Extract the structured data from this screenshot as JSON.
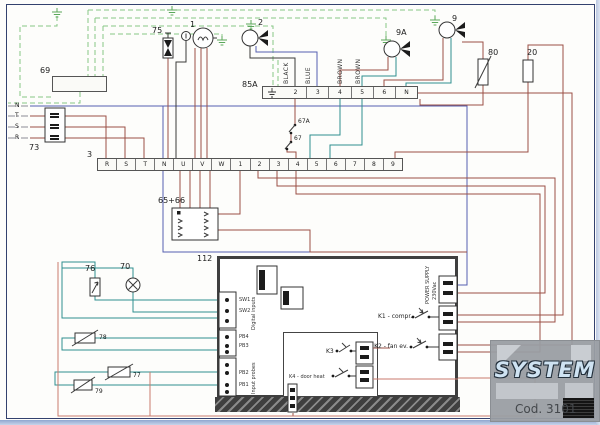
{
  "components": {
    "strip69": {
      "label": "69"
    },
    "fuse75": {
      "label": "75"
    },
    "compressor1": {
      "label": "1"
    },
    "fan2": {
      "label": "2"
    },
    "fan9a": {
      "label": "9A"
    },
    "fan9": {
      "label": "9"
    },
    "heater80": {
      "label": "80"
    },
    "resistor20": {
      "label": "20"
    },
    "fusebox73": {
      "label": "73"
    },
    "connector65_66": {
      "label": "65+66"
    },
    "switch67a": {
      "label": "67A"
    },
    "switch67": {
      "label": "67"
    },
    "door_switch76": {
      "label": "76"
    },
    "lamp70": {
      "label": "70"
    },
    "probe78": {
      "label": "78"
    },
    "probe77": {
      "label": "77"
    },
    "probe79": {
      "label": "79"
    }
  },
  "supply_lines": [
    "N",
    "T",
    "S",
    "R"
  ],
  "wire_labels": [
    "BLACK",
    "BLUE",
    "BROWN",
    "BROWN"
  ],
  "strip3": {
    "label": "3",
    "terminals": [
      "R",
      "S",
      "T",
      "N",
      "U",
      "V",
      "W",
      "1",
      "2",
      "3",
      "4",
      "5",
      "6",
      "7",
      "8",
      "9"
    ]
  },
  "strip85a": {
    "label": "85A",
    "terminals": [
      "2",
      "3",
      "4",
      "5",
      "6",
      "N"
    ]
  },
  "board": {
    "label": "112",
    "digital_inputs": "Digital inputs",
    "input_probes": "Input probes",
    "pin_labels": {
      "sw1": "SW1",
      "sw2": "SW2",
      "pb4": "PB4",
      "pb3": "PB3",
      "pb2": "PB2",
      "pb1": "PB1"
    },
    "power_supply_line1": "POWER SUPPLY",
    "power_supply_line2": "230Vac",
    "relay_k1": "K1 - compr.",
    "relay_k2": "K2 - fan ev.",
    "relay_k3": "K3",
    "relay_k4": "K4 - door heat"
  },
  "logo": {
    "brand": "SYSTEM",
    "code": "Cod. 3101"
  }
}
